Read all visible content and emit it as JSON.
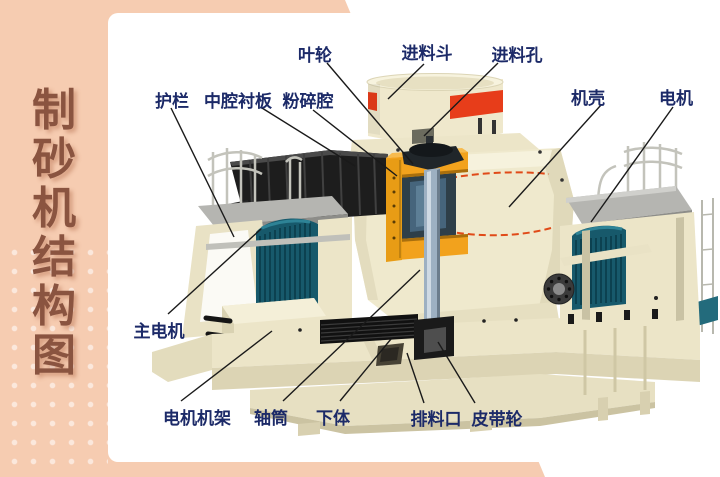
{
  "sidebar": {
    "title": "制砂机结构图",
    "chars": [
      "制",
      "砂",
      "机",
      "结",
      "构",
      "图"
    ]
  },
  "diagram": {
    "labels": [
      {
        "id": "impeller",
        "text": "叶轮"
      },
      {
        "id": "feed-hopper",
        "text": "进料斗"
      },
      {
        "id": "feed-hole",
        "text": "进料孔"
      },
      {
        "id": "guardrail",
        "text": "护栏"
      },
      {
        "id": "middle-chamber-liner",
        "text": "中腔衬板"
      },
      {
        "id": "crushing-chamber",
        "text": "粉碎腔"
      },
      {
        "id": "machine-shell",
        "text": "机壳"
      },
      {
        "id": "motor",
        "text": "电机"
      },
      {
        "id": "main-motor",
        "text": "主电机"
      },
      {
        "id": "motor-frame",
        "text": "电机机架"
      },
      {
        "id": "shaft-tube",
        "text": "轴筒"
      },
      {
        "id": "lower-body",
        "text": "下体"
      },
      {
        "id": "discharge-port",
        "text": "排料口"
      },
      {
        "id": "belt-pulley",
        "text": "皮带轮"
      }
    ],
    "colors": {
      "sidebar_peach": "#f6ccb1",
      "title_brown": "#8a5440",
      "label_navy": "#1c2a68",
      "machine_cream": "#efe9cd",
      "accent_red": "#e8401c",
      "accent_amber": "#f2a21d",
      "motor_teal": "#17596b",
      "shaft_steel": "#9db0c2"
    }
  }
}
